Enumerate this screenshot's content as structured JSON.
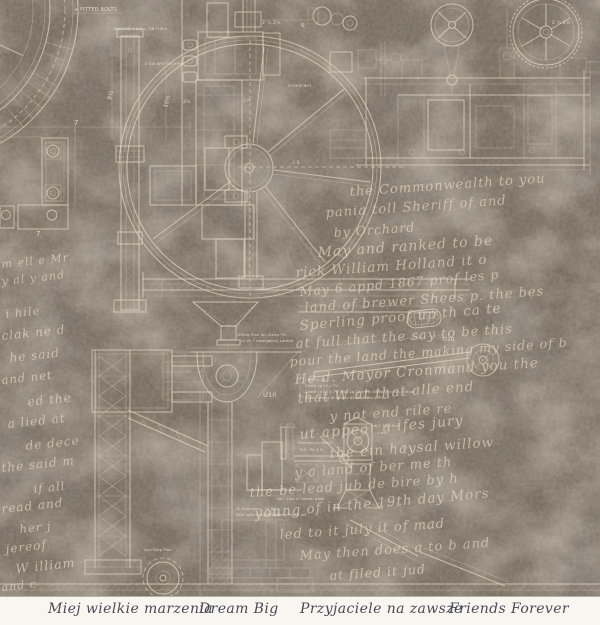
{
  "product": {
    "kind": "vintage blueprint scrapbook paper",
    "colors": {
      "background_base": "#6f6558",
      "background_dark_blotch": "#3f382f",
      "background_light_blotch": "#a89a86",
      "blueprint_line": "#e4dbc8",
      "script_ink": "#eee4cf",
      "footer_background": "#f8f6f1",
      "footer_text": "#4a4a55"
    }
  },
  "footer": {
    "phrases": [
      "Miej wielkie marzenia",
      "Dream Big",
      "Przyjaciele na zawsze",
      "Friends Forever"
    ]
  },
  "blueprint": {
    "labels": {
      "fitted_bolts": "+ FITTED BOLTS",
      "washer": "WASHER 4 DIA x 7/8 THICK",
      "screw": "2 DIA WHIT SCREW",
      "screw_nut": "SCREW NUT",
      "dim_10": "10½",
      "dim_9": "9½",
      "dim_7a": "7",
      "dim_7b": "7",
      "dim_6": "6",
      "dim_2a": "2  ½  2¼",
      "dim_2b": "2  ½  2½",
      "dim_2c": "2¼",
      "dim_2d": "2½",
      "dim_36": "3 6",
      "u10": "U10",
      "u20": "U20",
      "clevis_note_1": "Lifting Plan for Clevis Yih",
      "clevis_note_2": "14 Vk 7 emergency Lateral",
      "spec_1": "L B15-C-15",
      "spec_2": "Clevis Lp 15 x 7½",
      "spec_3": "Chock Lp 30 x 7½   Stop Lp 15 x 8½ Crossing x this Lattice",
      "spec_4": "Note: frames of hole to be at center of head.",
      "wheel_note": "Gen. Line of Wheel base",
      "eng_note_1": "W. Engineers, 74 long",
      "eng_note_2": "Rear with Counterbalance  Flush (d)",
      "strut_note_1": "Emergency Strut",
      "strut_note_2": "D.C. Plt 4 ft",
      "stop_bolt_1": "0.5 Stop Bolt",
      "stop_bolt_2": "4 day",
      "gun_ring": "Gun Ring Plan"
    }
  },
  "script": {
    "lines": [
      "the Commonwealth to you",
      "pania toll  Sheriff of  and",
      "by   Orchard",
      "May and  ranked to be",
      "rick  William  Holland  it o",
      "May 6 appd 1867 prof  les p",
      "land of brewer  Shees p. the  bes",
      "Sperling proof up  th  ca  te",
      "at full  that  the  say  to be  this",
      "pour the land  the making my side of b",
      "He d. Mayor Cronmand  you  the",
      "that  W  at that  alle  end",
      "y  not  end  rile  re",
      "ut appear  a  ifes  jury",
      "the  ein  haysal  willow",
      "y a  land of ber  me  th",
      "the be lead jub de  bire by  h",
      "young of  in the 19th day  Mors",
      "led  to it  july  it  of  mad",
      "May  then  does  a  to  b  and",
      "at  filed  it  jud",
      "i hile",
      "clak ne d",
      "he  said",
      "and  net",
      "ed  the",
      "a lied  at",
      "de  dece",
      "the said m",
      "if  all",
      "read  and",
      "her  j",
      "jereof",
      "W illiam",
      "and  c",
      "m ell e  Mr",
      "y  al   y and"
    ]
  }
}
